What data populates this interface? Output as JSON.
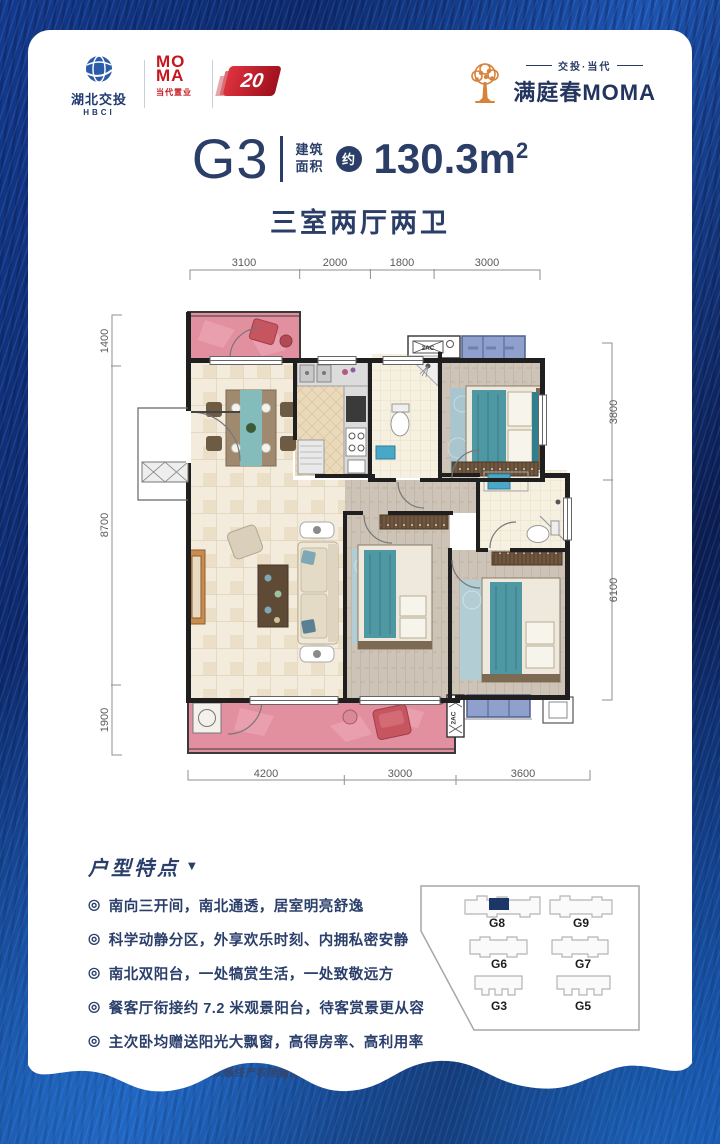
{
  "header": {
    "hbci": {
      "name": "湖北交投",
      "abbr": "HBCI"
    },
    "moma": {
      "line1": "MO",
      "line2": "MA",
      "sub": "当代置业"
    },
    "badge": "20",
    "project": {
      "tagline": "交投·当代",
      "name": "满庭春MOMA"
    }
  },
  "title": {
    "unit": "G3",
    "area_label1": "建筑",
    "area_label2": "面积",
    "approx": "约",
    "area_value": "130.3m",
    "area_sup": "2",
    "rooms": "三室两厅两卫"
  },
  "plan": {
    "dims_top": [
      "3100",
      "2000",
      "1800",
      "3000"
    ],
    "dims_left": [
      "1400",
      "8700",
      "1900"
    ],
    "dims_right": [
      "3800",
      "6100"
    ],
    "dims_bottom": [
      "4200",
      "3000",
      "3600"
    ],
    "ac_top": "2AC",
    "ac_bottom": "2AC"
  },
  "features": {
    "title": "户型特点",
    "arrow": "▼",
    "bullet": "◎",
    "items": [
      "南向三开间，南北通透，居室明亮舒逸",
      "科学动静分区，外享欢乐时刻、内拥私密安静",
      "南北双阳台，一处犒赏生活，一处致敬远方",
      "餐客厅衔接约 7.2 米观景阳台，待客赏景更从容",
      "主次卧均赠送阳光大飘窗，高得房率、高利用率"
    ],
    "footnote": "*本计划书中的房屋面积以最终产权测量面积为准"
  },
  "siteplan": {
    "units": [
      "G8",
      "G9",
      "G6",
      "G7",
      "G3",
      "G5"
    ]
  }
}
